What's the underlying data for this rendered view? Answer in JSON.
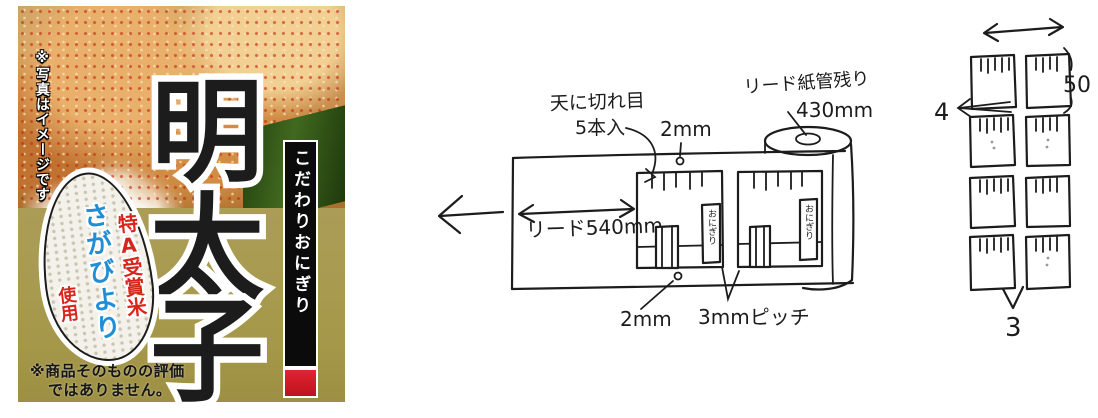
{
  "label": {
    "photo_note": "※写真はイメージです",
    "title": "明太子",
    "title_chars": [
      "明",
      "太",
      "子"
    ],
    "side_banner": "こだわりおにぎり",
    "rice_badge": {
      "award": "特A受賞米",
      "brand": "さがびより",
      "usage": "使用"
    },
    "disclaimer_line1": "※商品そのものの評価",
    "disclaimer_line2": "ではありません。",
    "colors": {
      "gold_bg": "#a89a52",
      "banner_bg": "#0b0b0b",
      "banner_accent_red": "#d01c24",
      "award_red": "#d8251c",
      "brand_blue": "#1f8ed6"
    }
  },
  "roll_diagram": {
    "cut_note_line1": "天に切れ目",
    "cut_note_line2": "5本入",
    "top_margin": "2mm",
    "core_note_line1": "リード紙管残り",
    "core_note_line2": "430mm",
    "lead_length": "リード540mm",
    "bottom_margin": "2mm",
    "pitch": "3mmピッチ",
    "package_label": "おにぎり"
  },
  "sheet_diagram": {
    "width_label": "50",
    "row_gap_label": "4",
    "bottom_label": "3",
    "rows": 4,
    "cols": 2
  },
  "ink_color": "#1c1c1c"
}
